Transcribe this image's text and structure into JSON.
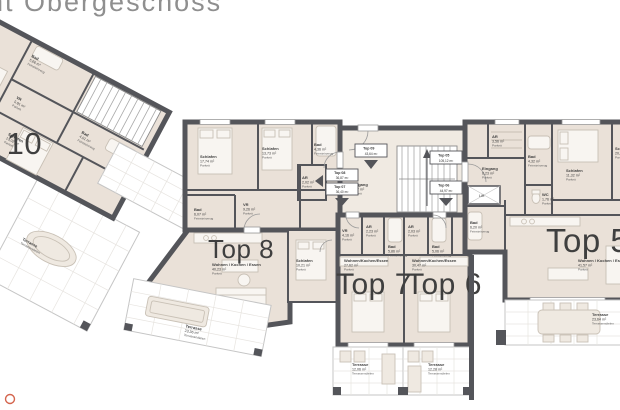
{
  "title": "nt Obergeschoss",
  "apartments": {
    "top10": {
      "label": "Top 10"
    },
    "top8": {
      "label": "Top 8"
    },
    "top7": {
      "label": "Top 7"
    },
    "top6": {
      "label": "Top 6"
    },
    "top5": {
      "label": "Top 5"
    }
  },
  "rooms": {
    "t10_bad1": {
      "name": "Bad",
      "area": "5,66 m²",
      "floor": "Feinsteinzeug"
    },
    "t10_vr": {
      "name": "VR",
      "area": "5,91 m²",
      "floor": "Parkett"
    },
    "t10_schlafen1": {
      "name": "Schlafen",
      "area": "13,30 m²",
      "floor": "Parkett"
    },
    "t10_bad2": {
      "name": "Bad",
      "area": "4,01 m²",
      "floor": "Feinsteinzeug"
    },
    "t10_schlafen2": {
      "name": "Schlafen",
      "area": "13,02 m²",
      "floor": "Parkett"
    },
    "t10_terrasse": {
      "name": "Terrasse",
      "area": "",
      "floor": "Terrassendielen"
    },
    "t8_schlafen1": {
      "name": "Schlafen",
      "area": "17,74 m²",
      "floor": "Parkett"
    },
    "t8_schlafen2": {
      "name": "Schlafen",
      "area": "13,73 m²",
      "floor": "Parkett"
    },
    "t8_bad1": {
      "name": "Bad",
      "area": "4,36 m²",
      "floor": "Feinsteinzeug"
    },
    "t8_ar": {
      "name": "AR",
      "area": "2,02 m²",
      "floor": "Parkett"
    },
    "t8_vr": {
      "name": "VR",
      "area": "9,26 m²",
      "floor": "Parkett"
    },
    "t8_bad2": {
      "name": "Bad",
      "area": "6,07 m²",
      "floor": "Feinsteinzeug"
    },
    "t8_wohnen": {
      "name": "Wohnen / Kochen / Essen",
      "area": "40,23 m²",
      "floor": "Parkett"
    },
    "t8_terrasse": {
      "name": "Terrasse",
      "area": "23,36 m²",
      "floor": "Terrassendielen"
    },
    "t7_schlafen": {
      "name": "Schlafen",
      "area": "10,21 m²",
      "floor": "Parkett"
    },
    "t7_vr": {
      "name": "VR",
      "area": "4,16 m²",
      "floor": "Parkett"
    },
    "t7_ar": {
      "name": "AR",
      "area": "2,23 m²",
      "floor": "Parkett"
    },
    "t7_bad": {
      "name": "Bad",
      "area": "5,86 m²",
      "floor": "Feinsteinzeug"
    },
    "t7_wohnen": {
      "name": "Wohnen/Kochen/Essen",
      "area": "27,62 m²",
      "floor": "Parkett"
    },
    "t7_terrasse": {
      "name": "Terrasse",
      "area": "12,06 m²",
      "floor": "Terrassendielen"
    },
    "t6_ar": {
      "name": "AR",
      "area": "2,03 m²",
      "floor": "Parkett"
    },
    "t6_bad": {
      "name": "Bad",
      "area": "5,06 m²",
      "floor": "Feinsteinzeug"
    },
    "t6_wohnen": {
      "name": "Wohnen/Kochen/Essen",
      "area": "30,47 m²",
      "floor": "Parkett"
    },
    "t6_terrasse": {
      "name": "Terrasse",
      "area": "12,28 m²",
      "floor": "Terrassendielen"
    },
    "t5_ar": {
      "name": "AR",
      "area": "3,56 m²",
      "floor": "Parkett"
    },
    "t5_eingang": {
      "name": "Eingang",
      "area": "6,23 m²",
      "floor": "Parkett"
    },
    "t5_bad1": {
      "name": "Bad",
      "area": "4,32 m²",
      "floor": "Feinsteinzeug"
    },
    "t5_wc": {
      "name": "WC",
      "area": "1,76 m²",
      "floor": "Parkett"
    },
    "t5_schlafen1": {
      "name": "Schlafen",
      "area": "11,32 m²",
      "floor": "Parkett"
    },
    "t5_schlafen2": {
      "name": "Schlafen",
      "area": "20,86 m²",
      "floor": "Parkett"
    },
    "t5_bad2": {
      "name": "Bad",
      "area": "6,20 m²",
      "floor": "Feinsteinzeug"
    },
    "t5_wohnen": {
      "name": "Wohnen / Kochen / Essen",
      "area": "41,57 m²",
      "floor": "Parkett"
    },
    "t5_terrasse": {
      "name": "Terrasse",
      "area": "23,64 m²",
      "floor": "Terrassendielen"
    },
    "core_eingang": {
      "name": "Eingang",
      "area": "1,17 m²",
      "floor": "Parkett"
    },
    "core_lift": {
      "name": "Lift"
    }
  },
  "badges": {
    "b09": {
      "no": "Top 09",
      "area": "43,64 m²"
    },
    "b08": {
      "no": "Top 08",
      "area": "36,87 m²"
    },
    "b07": {
      "no": "Top 07",
      "area": "36,40 m²"
    },
    "b05": {
      "no": "Top 05",
      "area": "105,12 m²"
    },
    "b06": {
      "no": "Top 06",
      "area": "44,97 m²"
    }
  },
  "colors": {
    "wall": "#54555a",
    "room_fill": "#eae1d8",
    "outdoor_line": "#c5c5c5",
    "title_gray": "#8f8f8f",
    "label_dark": "#3f3f3f",
    "accent_mark": "#d4654e",
    "background": "#ffffff"
  }
}
